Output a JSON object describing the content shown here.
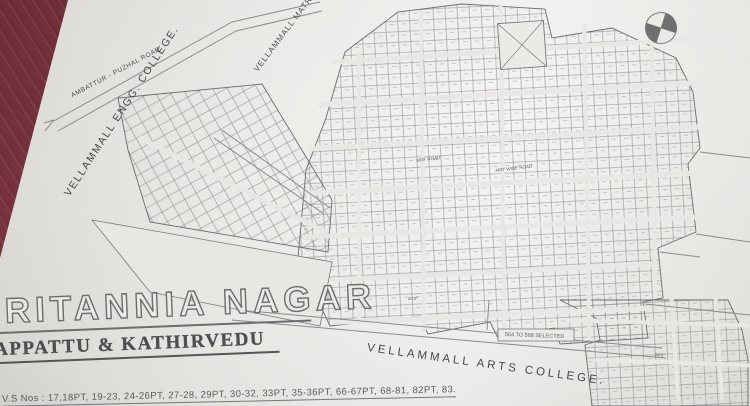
{
  "photo": {
    "surface": "maroon-fabric-tablecloth",
    "fabric_color": "#7d3540",
    "paper_color": "#e9e7e4"
  },
  "map": {
    "title": "BRITANNIA NAGAR",
    "subtitle": "APPATTU & KATHIRVEDU",
    "survey_line": "V.S Nos : 17,18PT, 19-23, 24-26PT, 27-28, 29PT, 30-32, 33PT, 35-36PT, 66-67PT, 68-81, 82PT, 83.",
    "landmarks": {
      "engg_college": "VELLAMMALL ENGG. COLLEGE.",
      "matric_school": "VELLAMMALL MATRIC S",
      "arts_college": "VELLAMMALL ARTS COLLEGE.",
      "main_road": "AMBATTUR - PUZHAL ROAD"
    },
    "notes": {
      "selected_plots": "564 TO 568 SELECTED"
    },
    "road_labels": [
      {
        "text": "40'0\" ROAD"
      },
      {
        "text": "40'0\" WIDE ROAD"
      },
      {
        "text": "24'0\""
      },
      {
        "text": "24'0\""
      }
    ],
    "icons": {
      "compass": "north-compass-rose"
    }
  }
}
